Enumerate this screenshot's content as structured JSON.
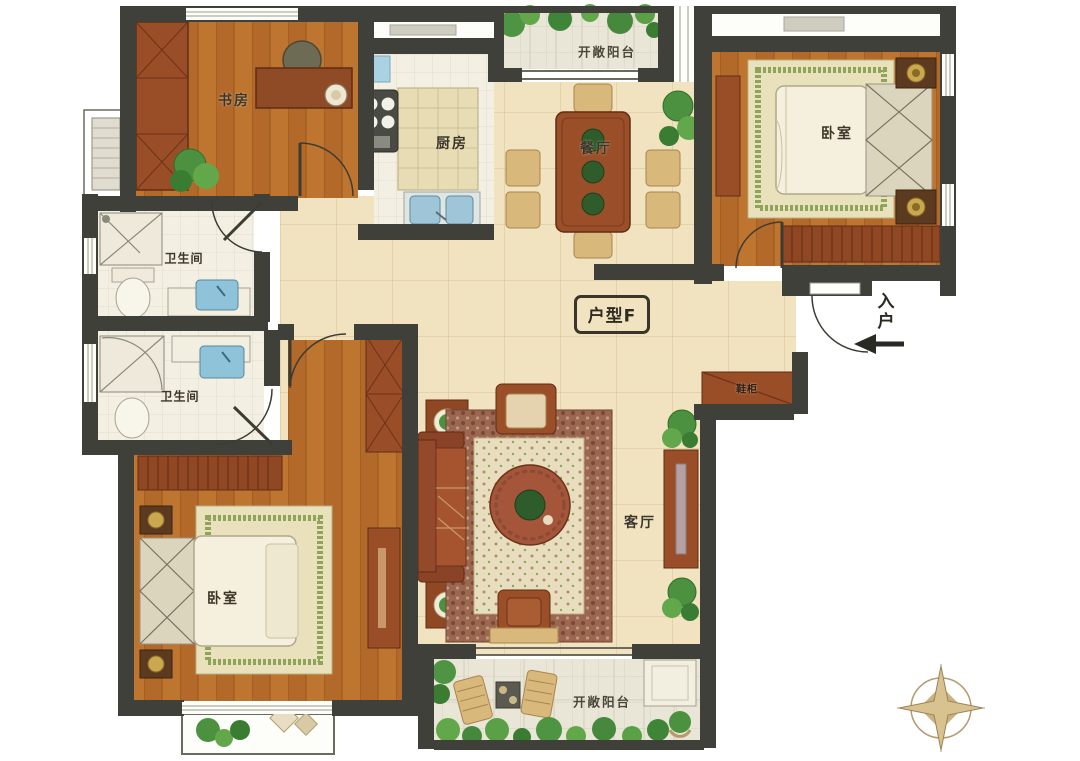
{
  "plan": {
    "unit_type": "户型F",
    "entry_label": "入户",
    "rooms": {
      "study": "书房",
      "kitchen": "厨房",
      "balcony_top": "开敞阳台",
      "dining": "餐厅",
      "bedroom_right": "卧室",
      "bathroom_upper": "卫生间",
      "bathroom_lower": "卫生间",
      "bedroom_left": "卧室",
      "living": "客厅",
      "balcony_bottom": "开敞阳台",
      "shoe_cabinet": "鞋柜"
    },
    "colors": {
      "wall": "#40403a",
      "wood_floor": "#b3692a",
      "tile_floor": "#f3efe2",
      "hall_floor": "#f1e3c0",
      "balcony_floor": "#e9e6d8",
      "furniture_red_brown": "#9a4e27",
      "furniture_tan": "#d9b87c",
      "plant_green": "#4c9140",
      "sink_blue": "#8fc3da",
      "rug_cream": "#e9e0bc",
      "compass_gold": "#c8ac72"
    }
  }
}
